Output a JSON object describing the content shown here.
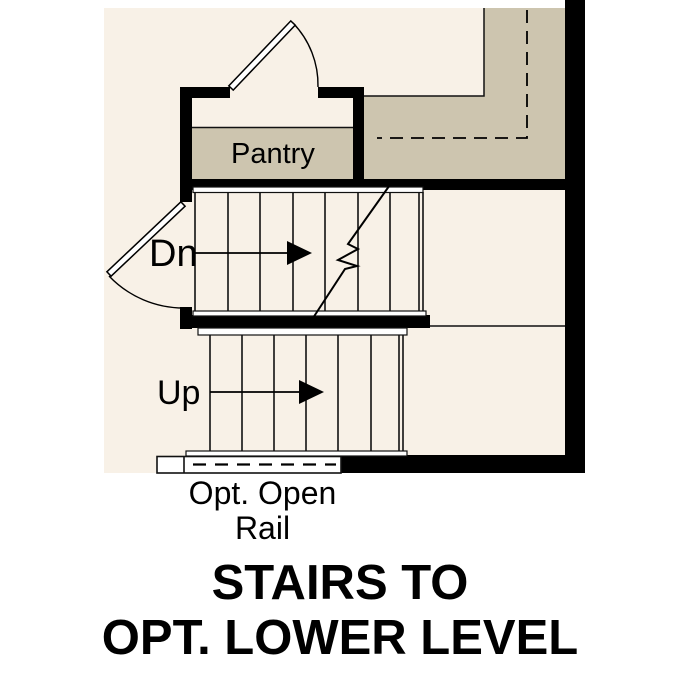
{
  "plan": {
    "room_labels": {
      "pantry": "Pantry"
    },
    "stair_labels": {
      "down": "Dn",
      "up": "Up"
    },
    "rail_caption": {
      "line1": "Opt. Open",
      "line2": "Rail"
    },
    "colors": {
      "floor": "#F8F1E7",
      "accent_floor": "#CDC5AF",
      "wall": "#000000",
      "line": "#111111",
      "page": "#FFFFFF"
    }
  },
  "title": {
    "line1": "STAIRS TO",
    "line2": "OPT. LOWER LEVEL"
  }
}
